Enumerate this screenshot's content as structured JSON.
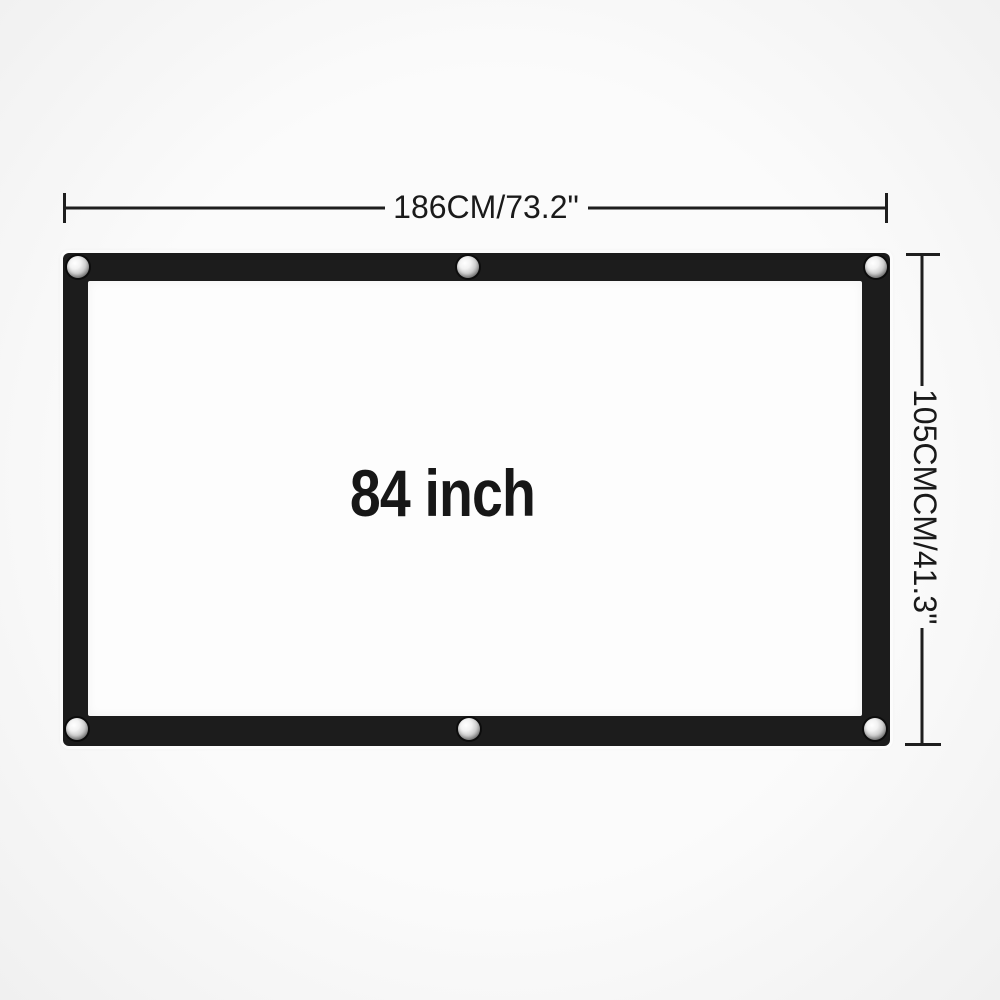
{
  "diagram": {
    "title": "projection screen size diagram",
    "screen_size_label": "84 inch",
    "width_dimension_label": "186CM/73.2\"",
    "height_dimension_label": "105CMCM/41.3\"",
    "colors": {
      "background": "#f6f6f6",
      "frame": "#1c1c1c",
      "surface": "#fdfdfd",
      "dimension_line": "#1e1e1e",
      "diagonal_line": "#4d4d4d",
      "grommet": "#cfcfcf"
    },
    "grommets": [
      {
        "icon": "grommet-icon",
        "position": "top-left"
      },
      {
        "icon": "grommet-icon",
        "position": "top-center"
      },
      {
        "icon": "grommet-icon",
        "position": "top-right"
      },
      {
        "icon": "grommet-icon",
        "position": "bottom-left"
      },
      {
        "icon": "grommet-icon",
        "position": "bottom-center"
      },
      {
        "icon": "grommet-icon",
        "position": "bottom-right"
      }
    ]
  }
}
